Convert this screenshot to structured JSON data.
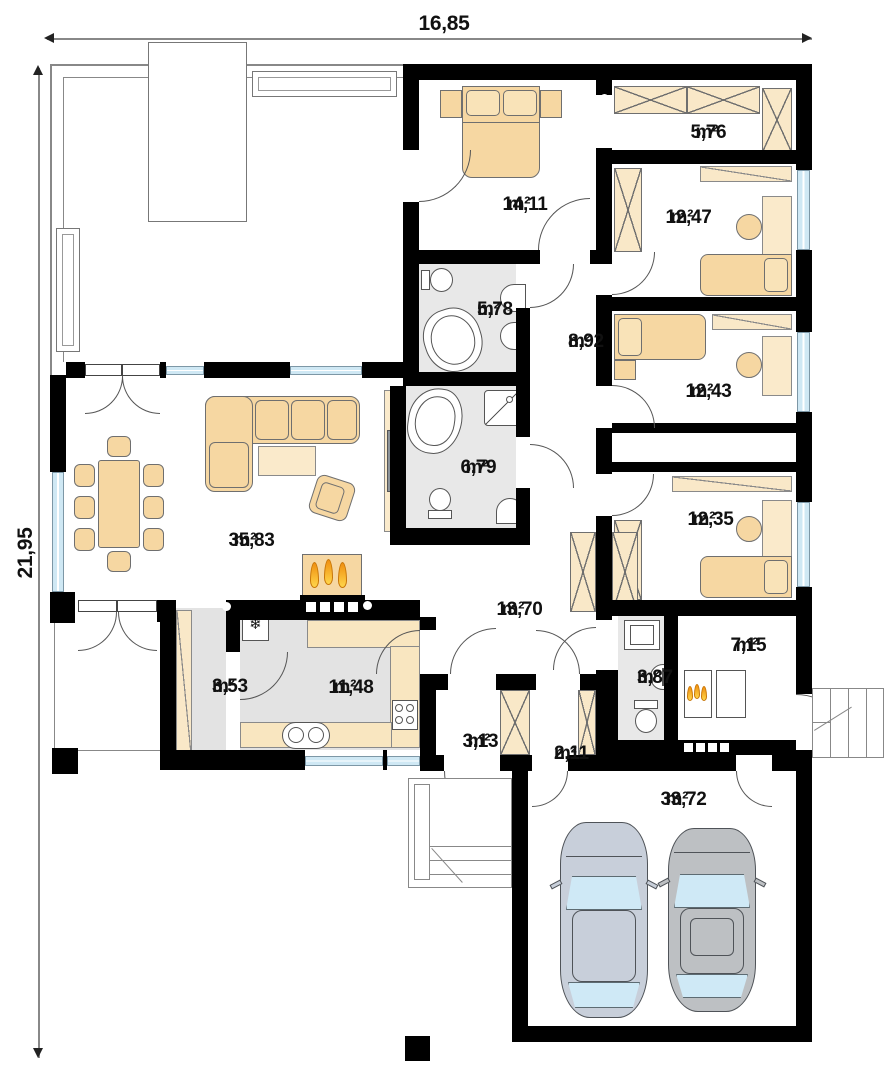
{
  "title": "single-storey house floor plan",
  "dimensions": {
    "width": "16,85",
    "height": "21,95"
  },
  "unit": "m²",
  "rooms": {
    "living": {
      "value": "35,83",
      "unit": "m²"
    },
    "bedroom": {
      "value": "14,11",
      "unit": "m²"
    },
    "wardrobe": {
      "value": "5,76",
      "unit": "m²"
    },
    "room1": {
      "value": "12,47",
      "unit": "m²"
    },
    "bath1": {
      "value": "5,78",
      "unit": "m²"
    },
    "hall": {
      "value": "8,92",
      "unit": "m²"
    },
    "room2": {
      "value": "12,43",
      "unit": "m²"
    },
    "bath2": {
      "value": "6,79",
      "unit": "m²"
    },
    "room3": {
      "value": "12,35",
      "unit": "m²"
    },
    "corridor": {
      "value": "13,70",
      "unit": "m²"
    },
    "pantry": {
      "value": "3,53",
      "unit": "m²"
    },
    "kitchen": {
      "value": "11,48",
      "unit": "m²"
    },
    "wc": {
      "value": "3,87",
      "unit": "m²"
    },
    "boiler": {
      "value": "7,15",
      "unit": "m²"
    },
    "entry": {
      "value": "3,13",
      "unit": "m²"
    },
    "vestibule": {
      "value": "2,11",
      "unit": "m²"
    },
    "garage": {
      "value": "33,72",
      "unit": "m²"
    }
  },
  "icons": {
    "freezer": "❄"
  },
  "colors": {
    "wall": "#000000",
    "furniture": "#f6d7a2",
    "furniture_light": "#faeacb",
    "floor_wet": "#e8e8e8",
    "window": "#cfe8f4",
    "flame": "#ef8f10",
    "car1": "#c8cfda",
    "car2": "#bdc0c3",
    "car_glass": "#cfe9f6"
  }
}
